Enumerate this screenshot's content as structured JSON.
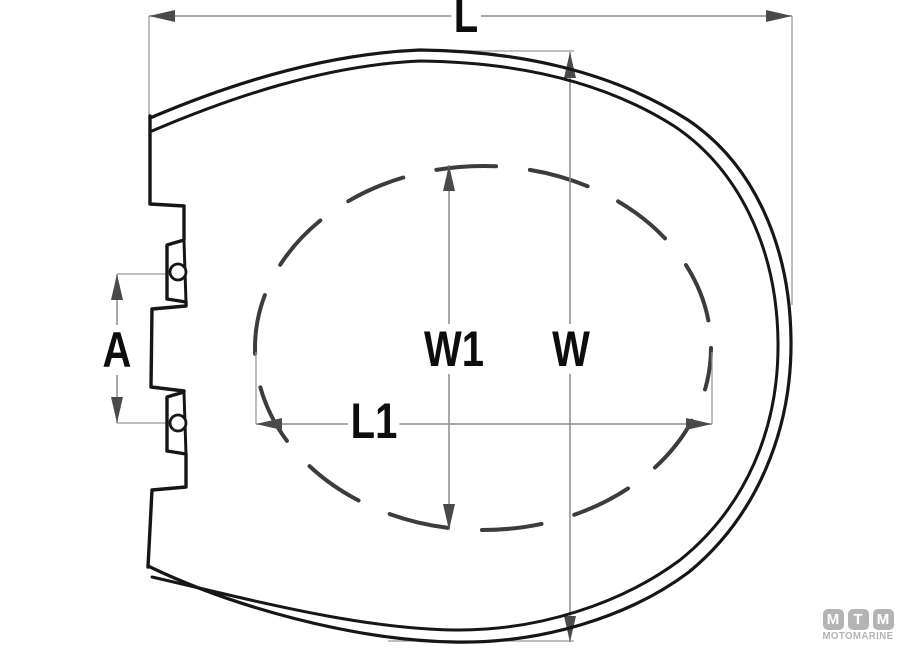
{
  "dimension_labels": {
    "length": "L",
    "width": "W",
    "inner_width": "W1",
    "inner_length": "L1",
    "hinge_pitch": "A"
  },
  "logo": {
    "tiles": [
      "M",
      "T",
      "M"
    ],
    "name": "MOTOMARINE"
  },
  "colors": {
    "background": "#ffffff",
    "outline": "#161616",
    "dashed_line": "#3c3c3c",
    "dimension_line": "#8c8c8c",
    "arrowhead": "#4a4a4a",
    "label_text": "#0d0d0d",
    "logo_gray": "#b4b4b6"
  }
}
